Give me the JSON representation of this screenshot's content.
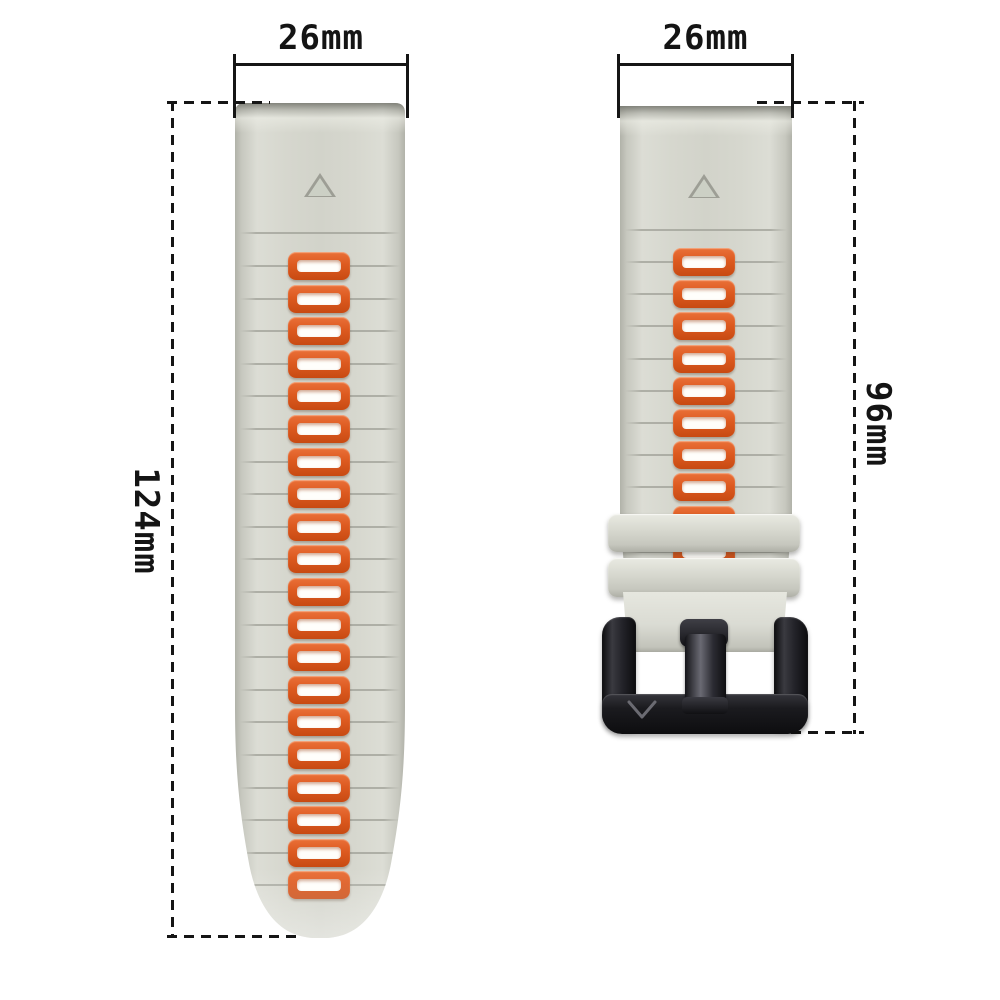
{
  "image": {
    "type": "watch-band product photo with measurements",
    "background_color": "#ffffff",
    "annotation_color": "#141414"
  },
  "annotations": {
    "left_strap_width": "26mm",
    "right_strap_width": "26mm",
    "left_strap_length": "124mm",
    "right_strap_length": "96mm"
  },
  "straps": {
    "left": {
      "description": "long tail strap with adjustment holes, rounded tip",
      "slot_count": 20,
      "body_color": "#d6d7ce",
      "slot_border_color": "#dd5a20",
      "slot_fill_color": "#fffefb",
      "triangle_marker": true
    },
    "right": {
      "description": "short buckle strap with two keeper loops and black buckle",
      "slot_count": 10,
      "keeper_count": 2,
      "body_color": "#d6d7ce",
      "slot_border_color": "#dd5a20",
      "slot_fill_color": "#fffefb",
      "buckle_color": "#1b1b1f",
      "buckle_logo": "V",
      "triangle_marker": true
    }
  }
}
